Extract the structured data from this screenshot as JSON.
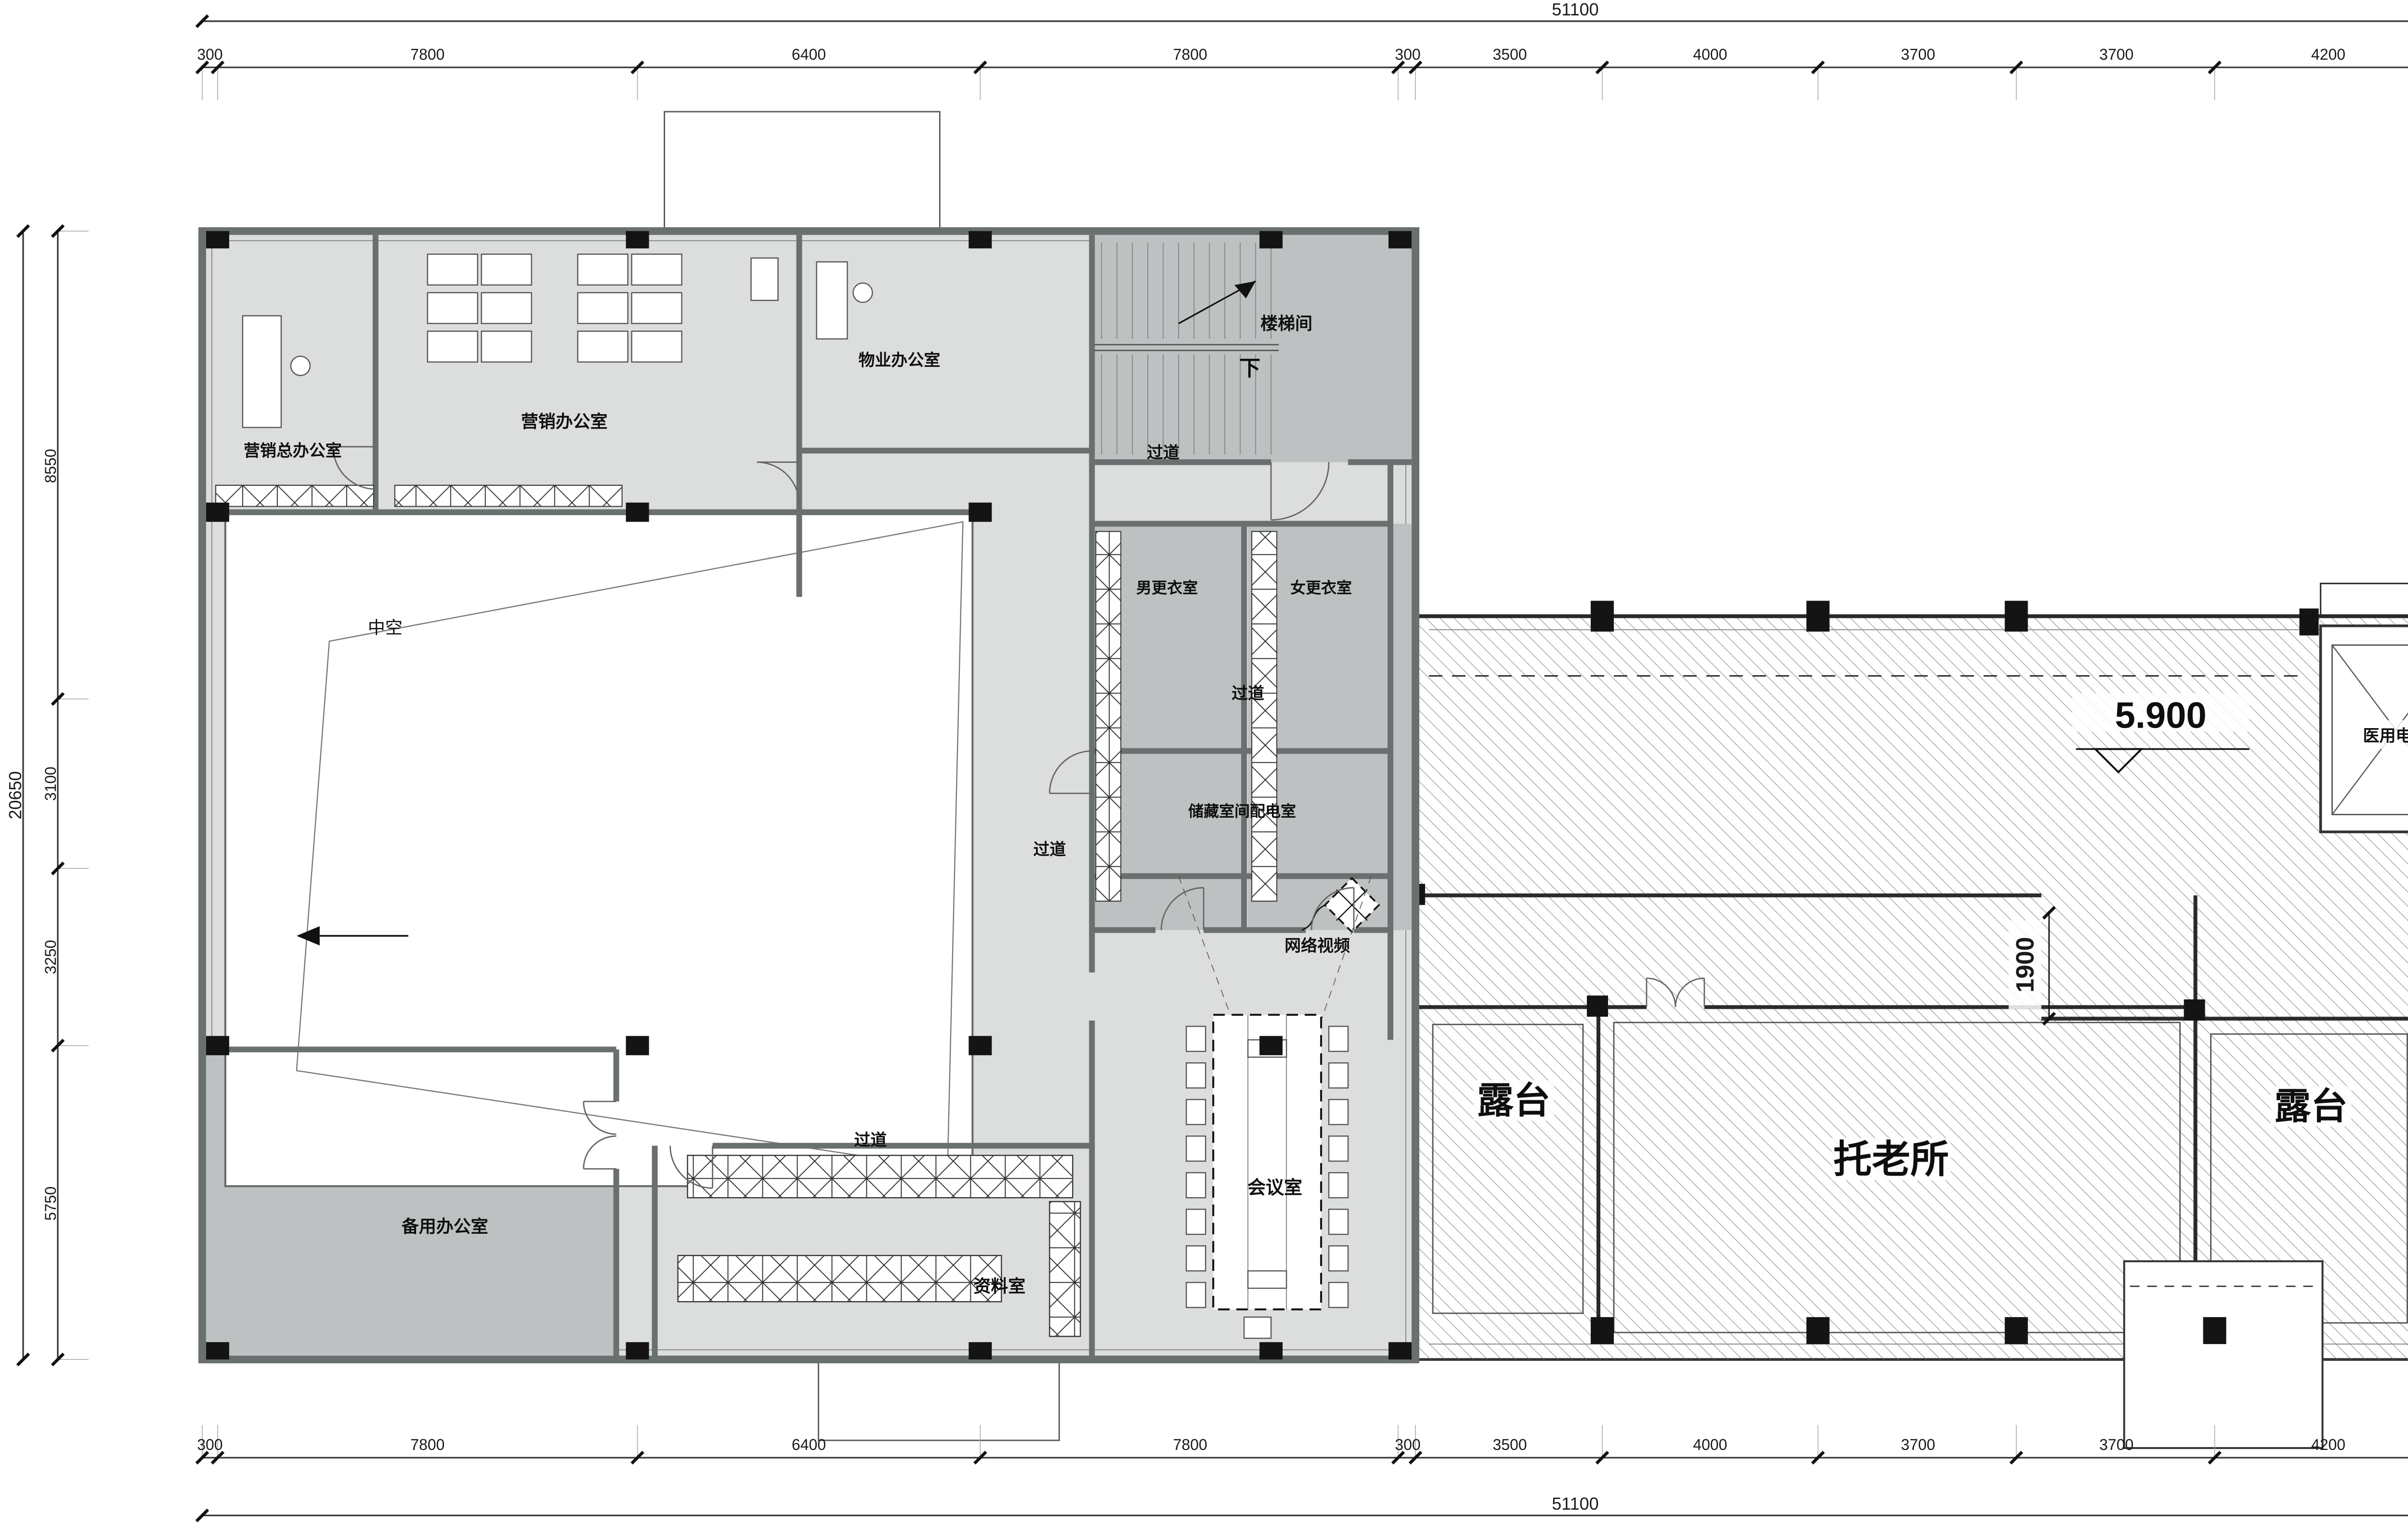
{
  "drawing": {
    "dims": {
      "top_total": "51100",
      "bottom_total": "51100",
      "left_total": "20650",
      "right_total": "20650",
      "top": [
        "300",
        "7800",
        "6400",
        "7800",
        "300",
        "3500",
        "4000",
        "3700",
        "3700",
        "4200",
        "4700",
        "4700"
      ],
      "bottom": [
        "300",
        "7800",
        "6400",
        "7800",
        "300",
        "3500",
        "4000",
        "3700",
        "3700",
        "4200",
        "4700",
        "4700"
      ],
      "left": [
        "8550",
        "3100",
        "3250",
        "5750"
      ],
      "right": [
        "7050",
        "3100",
        "4400",
        "6100"
      ],
      "opening": "1900"
    },
    "rooms": {
      "marketing_director_office": "营销总办公室",
      "marketing_office": "营销办公室",
      "property_office": "物业办公室",
      "stairwell": "楼梯间",
      "corridor": "过道",
      "mens_changing_room": "男更衣室",
      "womens_changing_room": "女更衣室",
      "atrium_void": "中空",
      "storage_power_room": "储藏室间配电室",
      "network_video": "网络视频",
      "meeting_room": "会议室",
      "spare_office": "备用办公室",
      "archive_room": "资料室",
      "terrace": "露台",
      "elderly_care": "托老所",
      "medical_elevator": "医用电梯"
    },
    "annotations": {
      "elevation": "5.900",
      "down": "下"
    },
    "colors": {
      "floor": "#dcdddd",
      "room_gray": "#bdc1c1",
      "wall": "#6a6f6f",
      "column": "#141414"
    }
  }
}
